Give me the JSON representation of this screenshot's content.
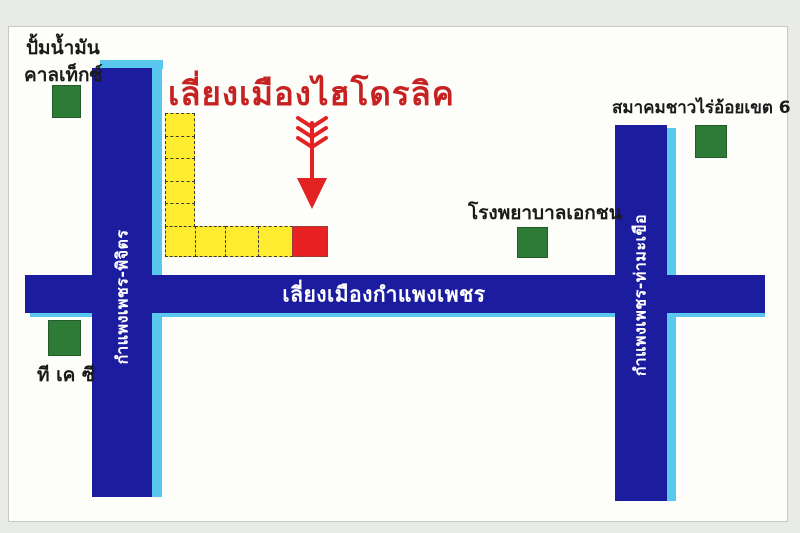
{
  "title": {
    "text": "เลี่ยงเมืองไฮโดรลิค"
  },
  "roads": {
    "horizontal": {
      "label": "เลี่ยงเมืองกำแพงเพชร"
    },
    "left_vertical": {
      "label": "กำแพงเพชร-พิจิตร"
    },
    "right_vertical": {
      "label": "กำแพงเพชร-ท่ามะเขือ"
    }
  },
  "landmarks": {
    "caltex": {
      "line1": "ปั้มน้ำมัน",
      "line2": "คาลเท็กซ์"
    },
    "tkc": {
      "label": "ที เค ซี"
    },
    "hospital": {
      "label": "โรงพยาบาลเอกชน"
    },
    "sugarcane_association": {
      "label": "สมาคมชาวไร่อ้อยเขต 6"
    }
  },
  "destination": {
    "marker": "down-arrow",
    "shop_row_note": "L-shape of shop blocks, destination block highlighted red"
  },
  "colors": {
    "road": "#1c1c9e",
    "road_accent": "#5ac8ee",
    "block_yellow": "#ffec30",
    "block_red": "#e82222",
    "landmark_green": "#2e7b38",
    "title_red": "#c62222",
    "arrow_red": "#e32222",
    "text_black": "#1a1a1a",
    "road_text": "#ffffff",
    "background": "#e9ebe6",
    "card": "#fdfdfa"
  }
}
